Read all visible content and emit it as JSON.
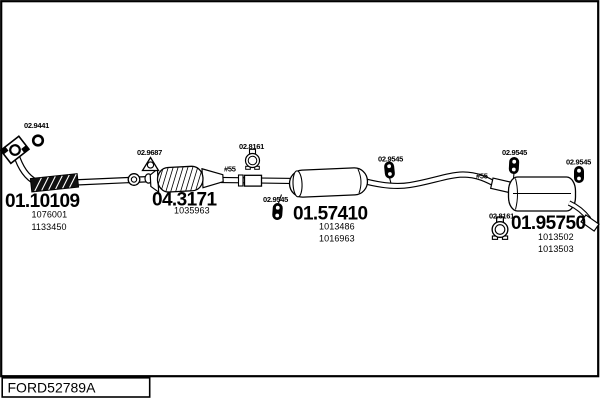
{
  "diagram_code": "FORD52789A",
  "parts": {
    "front_pipe": {
      "number": "01.10109",
      "oe_refs": [
        "1076001",
        "1133450"
      ]
    },
    "catalyst": {
      "number": "04.3171",
      "oe_refs": [
        "1035963"
      ]
    },
    "centre_silencer": {
      "number": "01.57410",
      "oe_refs": [
        "1013486",
        "1016963"
      ]
    },
    "rear_silencer": {
      "number": "01.95750",
      "oe_refs": [
        "1013502",
        "1013503"
      ]
    }
  },
  "fittings": {
    "gasket_ring": "02.9441",
    "bracket_gasket": "02.9687",
    "clamp_front": "02.8161",
    "clamp_rear": "02.8161",
    "hanger_front": "02.9545",
    "hanger_centre": "02.9545",
    "hanger_rear_left": "02.9545",
    "hanger_rear_right": "02.9545",
    "joint_front": "#55",
    "joint_rear": "#55"
  },
  "colors": {
    "ink": "#000000",
    "paper": "#ffffff"
  }
}
